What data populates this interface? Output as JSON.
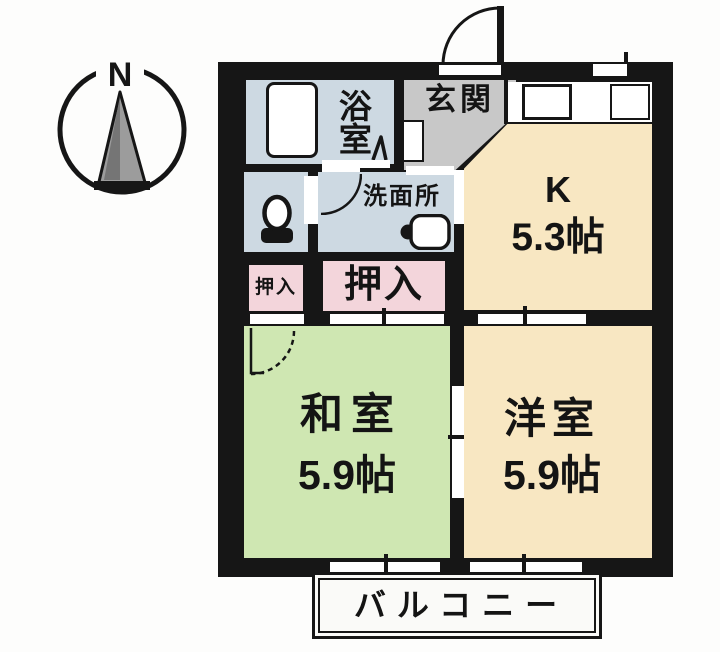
{
  "compass": {
    "north_label": "N"
  },
  "rooms": {
    "bath": {
      "label": "浴室"
    },
    "washroom": {
      "label": "洗面所"
    },
    "entrance": {
      "label": "玄関"
    },
    "kitchen": {
      "label": "K",
      "size": "5.3帖"
    },
    "closet_small": {
      "label": "押入"
    },
    "closet_large": {
      "label": "押入"
    },
    "japanese_room": {
      "label": "和室",
      "size": "5.9帖"
    },
    "western_room": {
      "label": "洋室",
      "size": "5.9帖"
    },
    "balcony": {
      "label": "バルコニー"
    }
  },
  "icons": {
    "compass_arrow": "north-arrow-icon",
    "bathtub": "bathtub-icon",
    "bath_door": "folding-door-icon",
    "toilet": "toilet-icon",
    "sink": "sink-icon",
    "entrance_door": "door-swing-icon",
    "washroom_door": "door-arc-icon",
    "japanese_room_door": "door-arc-dashed-icon"
  },
  "colors": {
    "wall": "#161616",
    "wet_area": "#cdd9e2",
    "closet": "#f3d5db",
    "tatami": "#cfe7b2",
    "flooring": "#f8e7c2",
    "entrance": "#c8c8c8",
    "balcony": "#fafaf8",
    "text": "#141414"
  }
}
